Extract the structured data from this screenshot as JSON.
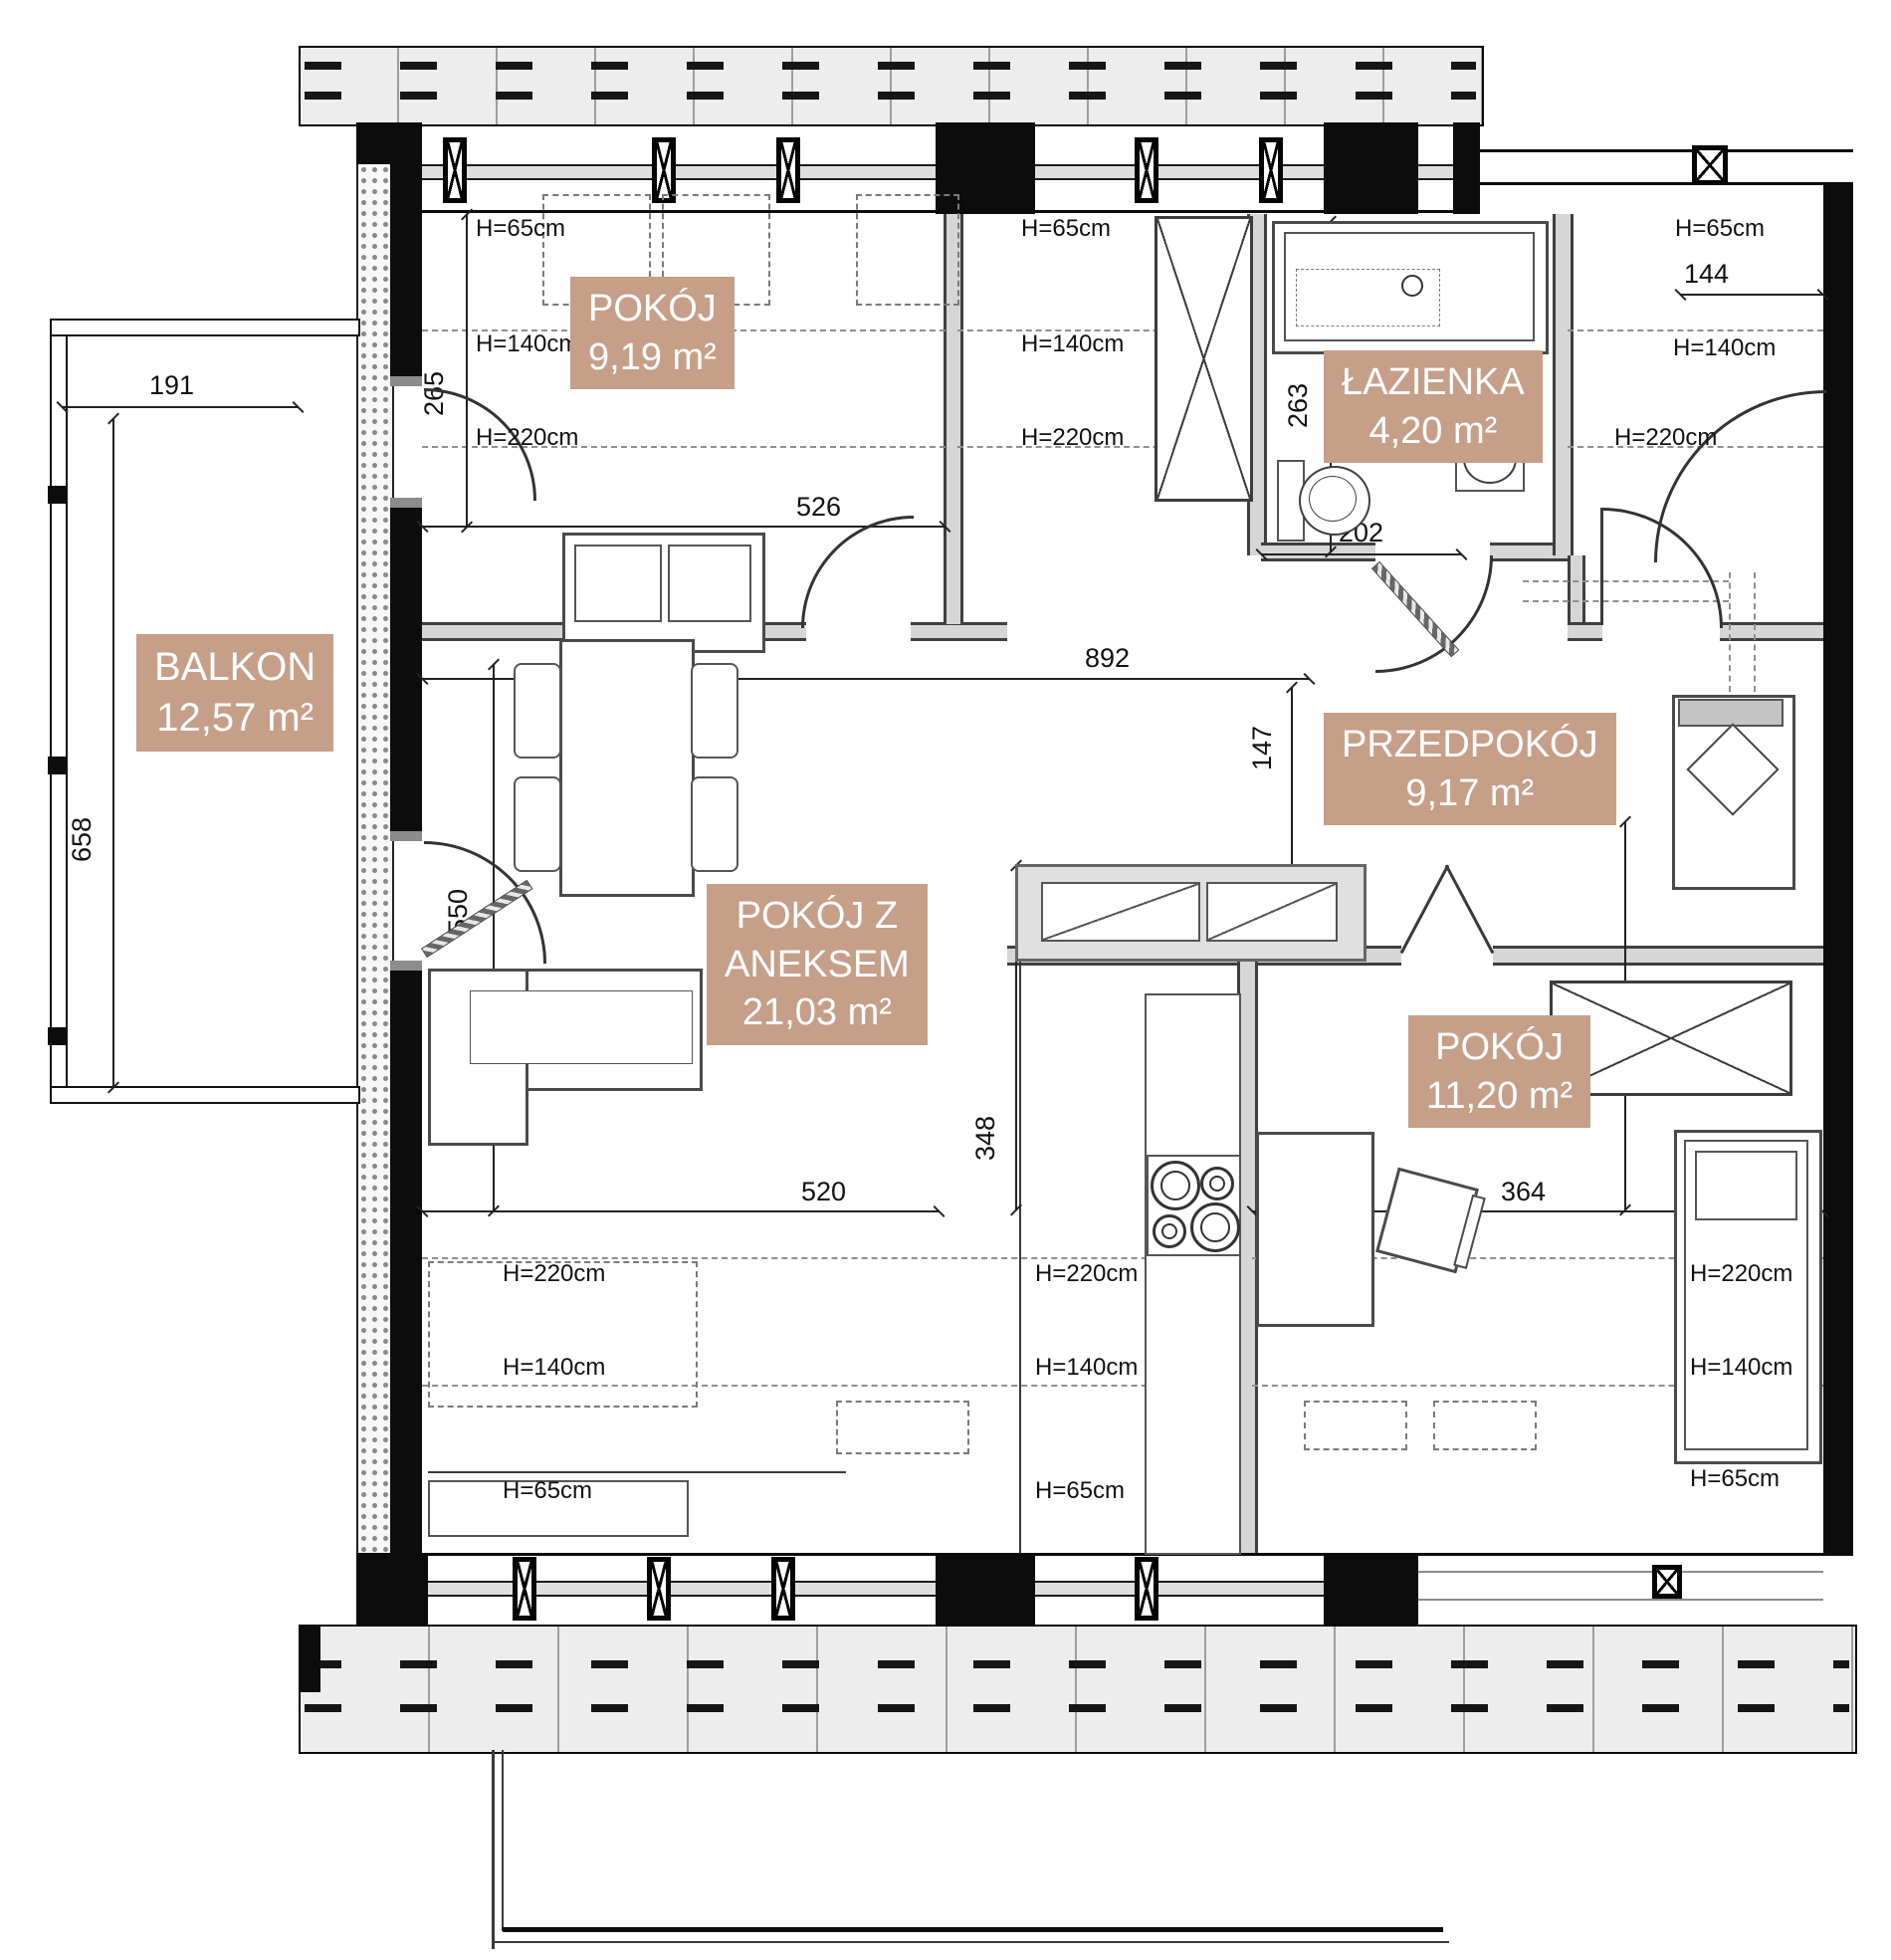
{
  "title": "Rzut mieszkania",
  "rooms": {
    "balkon": {
      "name": "BALKON",
      "area": "12,57 m²"
    },
    "pokoj1": {
      "name": "POKÓJ",
      "area": "9,19 m²"
    },
    "lazienka": {
      "name": "ŁAZIENKA",
      "area": "4,20 m²"
    },
    "przedpokoj": {
      "name": "PRZEDPOKÓJ",
      "area": "9,17 m²"
    },
    "salon": {
      "line1": "POKÓJ Z",
      "line2": "ANEKSEM",
      "area": "21,03 m²"
    },
    "pokoj2": {
      "name": "POKÓJ",
      "area": "11,20 m²"
    }
  },
  "dims": {
    "d191": "191",
    "d658": "658",
    "d265": "265",
    "d526": "526",
    "d892": "892",
    "d550": "550",
    "d263": "263",
    "d202": "202",
    "d144": "144",
    "d147": "147",
    "d520": "520",
    "d348": "348",
    "d364": "364",
    "d393": "393"
  },
  "heights": {
    "h65": "H=65cm",
    "h140": "H=140cm",
    "h220": "H=220cm"
  },
  "colors": {
    "label_bg": "#c69f89",
    "wall": "#0c0c0c",
    "eaves_fill": "#ededed"
  }
}
